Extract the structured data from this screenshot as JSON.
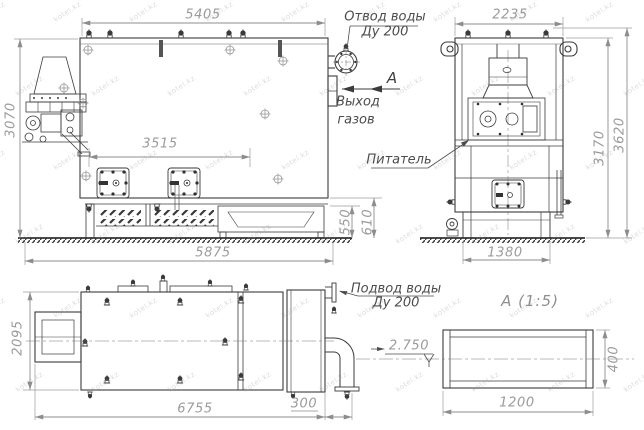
{
  "drawing": {
    "side_view": {
      "dim_width_top": "5405",
      "dim_height_left": "3070",
      "dim_doors_width": "3515",
      "dim_width_bottom": "5875",
      "dim_grate_height": "550",
      "dim_base_height": "610",
      "water_outlet_label_line1": "Отвод воды",
      "water_outlet_label_line2": "Ду 200",
      "gas_exit_label_line1": "Выход",
      "gas_exit_label_line2": "газов",
      "section_arrow_letter": "А"
    },
    "front_view": {
      "dim_width_top": "2235",
      "dim_height_body": "3170",
      "dim_height_total": "3620",
      "dim_width_bottom": "1380",
      "feeder_label": "Питатель"
    },
    "plan_view": {
      "dim_depth_left": "2095",
      "dim_length_bottom": "6755",
      "dim_outlet_offset": "300",
      "water_inlet_label_line1": "Подвод воды",
      "water_inlet_label_line2": "Ду 200",
      "elevation_mark": "2.750"
    },
    "section_view": {
      "title": "А  (1:5)",
      "dim_width": "1200",
      "dim_height": "400"
    },
    "watermark_text": "kotel.kz"
  }
}
